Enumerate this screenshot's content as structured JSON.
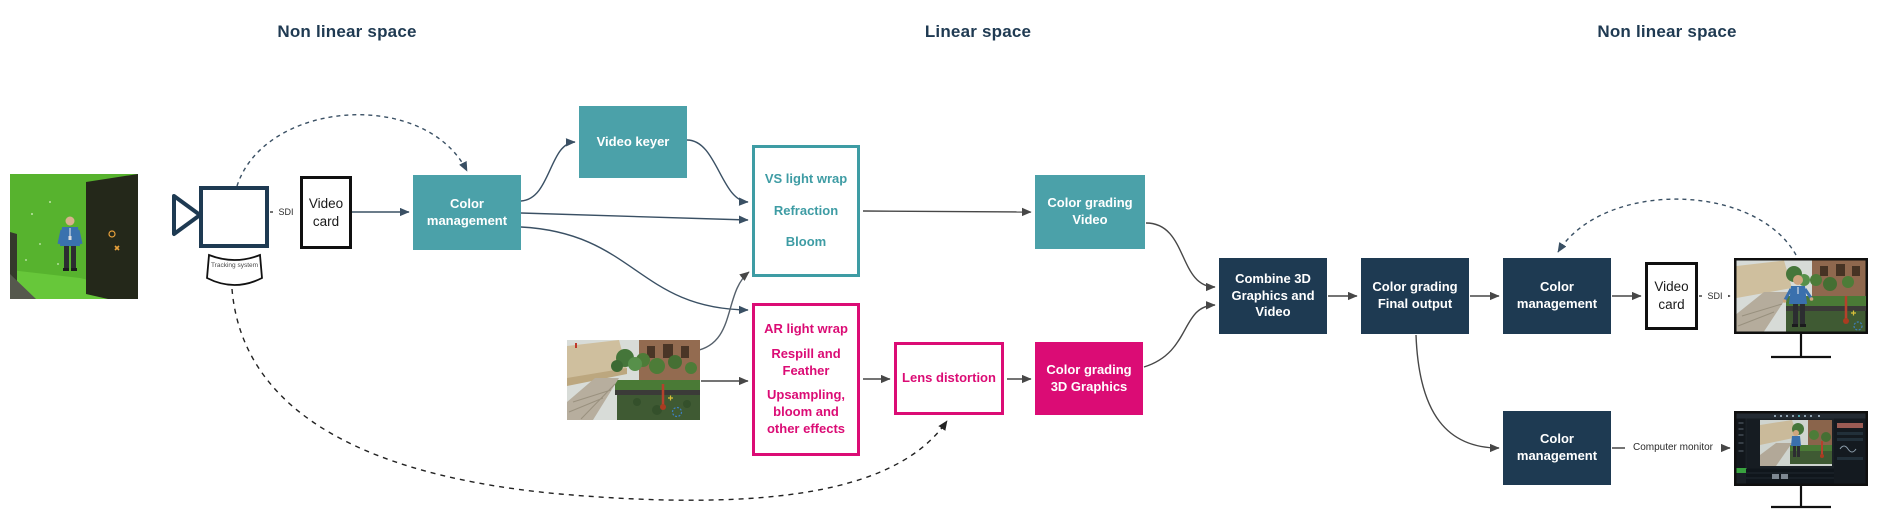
{
  "headings": {
    "left": "Non linear space",
    "center": "Linear space",
    "right": "Non linear space"
  },
  "labels": {
    "sdi": "SDI",
    "computer_monitor": "Computer monitor",
    "tracking_system": "Tracking system"
  },
  "nodes": {
    "video_card_in": "Video card",
    "color_management_in": "Color management",
    "video_keyer": "Video keyer",
    "vs_effects": [
      "VS light wrap",
      "Refraction",
      "Bloom"
    ],
    "ar_effects": [
      "AR light wrap",
      "Respill and Feather",
      "Upsampling, bloom and other effects"
    ],
    "lens_distortion": "Lens distortion",
    "color_grading_video": "Color grading Video",
    "color_grading_3d": "Color grading 3D Graphics",
    "combine": "Combine 3D Graphics and Video",
    "color_grading_final": "Color grading Final output",
    "color_management_out_top": "Color management",
    "video_card_out": "Video card",
    "color_management_out_bottom": "Color management"
  },
  "colors": {
    "teal": "#4BA1A9",
    "pink": "#DB0C75",
    "navy": "#1E3A52",
    "connector": "#3A5064"
  }
}
